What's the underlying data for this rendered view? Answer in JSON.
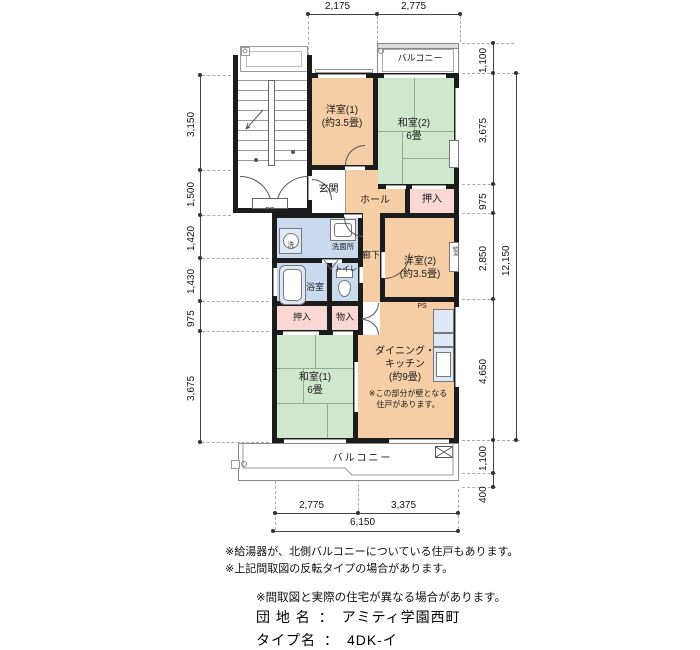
{
  "colors": {
    "wall": "#1c1c1c",
    "peach": "#f6cea5",
    "green": "#cfe7cc",
    "pink": "#f9d8d3",
    "blue": "#c9d9ee"
  },
  "rooms": {
    "yoshitsu1": {
      "name": "洋室(1)",
      "size": "(約3.5畳)"
    },
    "washitsu2": {
      "name": "和室(2)",
      "size": "6畳"
    },
    "genkan": {
      "name": "玄関"
    },
    "hall": {
      "name": "ホール"
    },
    "oshiire_upper": {
      "name": "押入"
    },
    "senmenjo": {
      "name": "洗面所"
    },
    "sen": {
      "name": "洗"
    },
    "yokushitsu": {
      "name": "浴室"
    },
    "toilet": {
      "name": "トイレ"
    },
    "rouka": {
      "name": "廊下"
    },
    "yoshitsu2": {
      "name": "洋室(2)",
      "size": "(約3.5畳)"
    },
    "oshiire_lower": {
      "name": "押入"
    },
    "monoire": {
      "name": "物入"
    },
    "washitsu1": {
      "name": "和室(1)",
      "size": "6畳"
    },
    "dk": {
      "name": "ダイニング・",
      "name2": "キッチン",
      "size": "(約9畳)",
      "note1": "※この部分が壁となる",
      "note2": "住戸があります。"
    },
    "balcony_top": {
      "name": "バルコニー"
    },
    "balcony_bottom": {
      "name": "バルコニー"
    }
  },
  "labels": {
    "ps_stair": "PS",
    "ps_dk": "PS",
    "kyuto": "給湯"
  },
  "dimensions": {
    "top": [
      "2,175",
      "2,775"
    ],
    "bottom": [
      "2,775",
      "3,375"
    ],
    "bottom_total": "6,150",
    "left": [
      "3,150",
      "1,500",
      "1,420",
      "1,430",
      "975",
      "3,675"
    ],
    "right": [
      "1,100",
      "3,675",
      "975",
      "2,850",
      "4,650",
      "1,100",
      "400"
    ],
    "right_total": "12,150"
  },
  "notes": {
    "note1": "※給湯器が、北側バルコニーについている住戸もあります。",
    "note2": "※上記間取図の反転タイプの場合があります。",
    "note3": "※間取図と実際の住宅が異なる場合があります。"
  },
  "title_block": {
    "site_label": "団 地 名",
    "site_sep": "：",
    "site_name": "アミティ学園西町",
    "type_label": "タイプ名",
    "type_sep": "：",
    "type_name": "4DK-イ"
  }
}
